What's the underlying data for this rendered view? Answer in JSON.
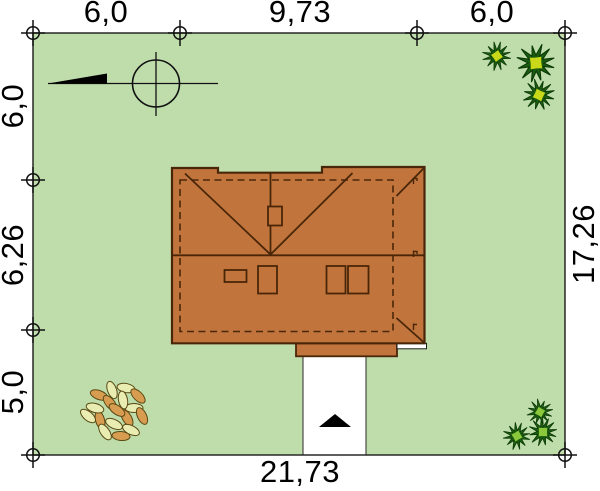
{
  "document": {
    "kind": "house-site-plan",
    "view": "roof-plan-top-view"
  },
  "dimensions": {
    "top_left": "6,0",
    "top_middle": "9,73",
    "top_right": "6,0",
    "left_upper": "6,0",
    "left_middle": "6,26",
    "left_lower": "5,0",
    "right_side": "17,26",
    "bottom": "21,73"
  },
  "colors": {
    "grass": "#bfdcab",
    "roof": "#c1753c",
    "roof_outline": "#4a2608",
    "boundary_line": "#1a1a1a",
    "driveway": "#ffffff",
    "white_step": "#ffffff",
    "entrance_arrow": "#000000",
    "tree_dark_green": "#1c5c10",
    "tree_yellow_center": "#c9d818",
    "tree_green_center": "#8cc83c",
    "bush_leaf_pale": "#e9edb2",
    "bush_leaf_tan": "#d89c50",
    "text": "#000000"
  },
  "icons": {
    "north_arrow": "solid black triangle pointer on survey line",
    "compass_circle": "circle with crosshair",
    "survey_marker": "small circle with cross at plot boundary points",
    "conifer_bush": "spiky starburst shrub",
    "leafy_bush": "cluster of leaves",
    "entrance_arrow": "black triangle pointing up on driveway"
  }
}
